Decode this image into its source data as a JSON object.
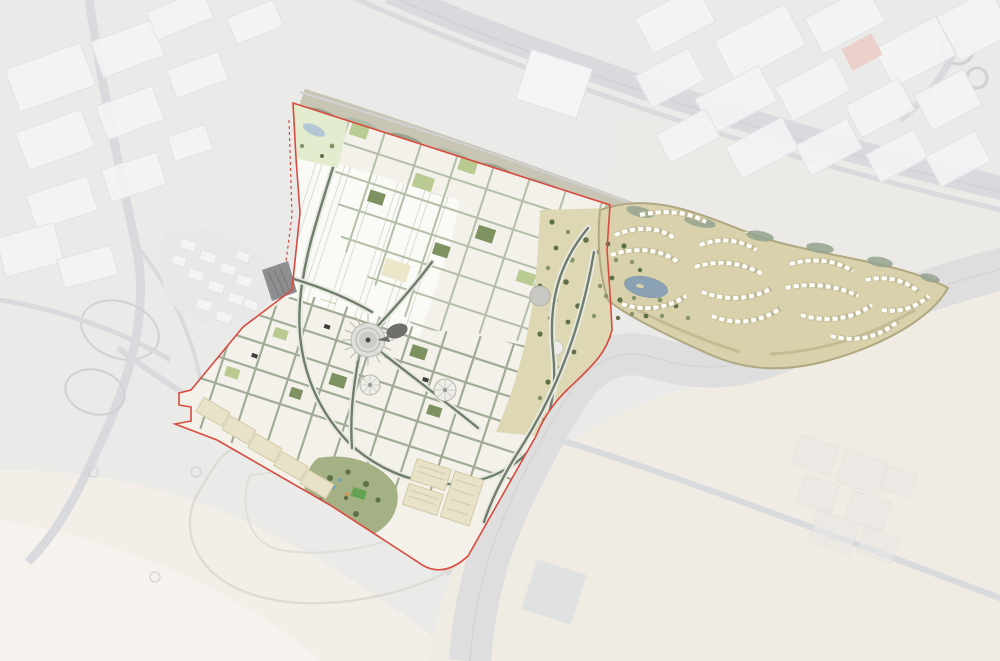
{
  "meta": {
    "type": "masterplan-aerial-map",
    "description": "Aerial-view masterplan rendering: a brightly colored expo-style development site outlined in red over a muted, washed-out desert city context. No visible text labels.",
    "visible_text": []
  },
  "palette": {
    "bg_gray": "#eaeae9",
    "bg_desert": "#f0ebe3",
    "bg_desert_light": "#f3efe8",
    "muted_road": "#d9dadd",
    "muted_road_dark": "#cfd1d5",
    "muted_building": "#f3f4f5",
    "muted_outline": "#e0e2e4",
    "wadi_base": "#c9c5b4",
    "wadi_green": "#94a48e",
    "wadi_green_light": "#adbaa6",
    "site_base": "#f3f1ea",
    "halls_white": "#fafaf7",
    "hall_outline": "#dbdad2",
    "street_sage": "#b3bfa8",
    "street_sage_dark": "#a0ac95",
    "avenue_dark": "#6f7e6c",
    "avenue_casing": "#e9e9e2",
    "block_white": "#f7f6f1",
    "courtyard_green": "#7d9161",
    "courtyard_light": "#b9cb92",
    "tree_dark": "#5f7048",
    "tree_olive": "#87936b",
    "tan_park": "#ded7b3",
    "villa_base": "#d8d1ac",
    "villa_ridge": "#b0a881",
    "villa_row_base": "#c2ba98",
    "villa_white": "#fdfdfa",
    "lake_blue": "#8ba1b4",
    "pond_blue": "#b4c7d5",
    "pond_park": "#e3ecce",
    "plaza_ring": "#dededa",
    "plaza_inner": "#ccccc7",
    "plaza_dark": "#4a4a48",
    "pav_gray": "#c9c8c3",
    "dark_building": "#8e8e90",
    "boundary_red": "#d84b3f",
    "parking_beige": "#e8e2c8",
    "parking_line": "#d3caa6",
    "field_green": "#63a24f",
    "accent_blue": "#6f9ec6",
    "accent_orange": "#d9934e"
  },
  "features": [
    {
      "name": "site-boundary",
      "kind": "red outline around highlighted masterplan site"
    },
    {
      "name": "exhibition-halls",
      "kind": "large white hall buildings, north-west of site"
    },
    {
      "name": "metro-station",
      "kind": "dark grey fan-shaped station on west boundary"
    },
    {
      "name": "pond-park",
      "kind": "small green park with pond, north-west corner"
    },
    {
      "name": "wadi-linear-park",
      "kind": "muted green landscape strip along north edge"
    },
    {
      "name": "north-grid-district",
      "kind": "street grid with green courtyards"
    },
    {
      "name": "central-plaza",
      "kind": "circular plaza with radiating streets"
    },
    {
      "name": "dome-pavilions",
      "kind": "two white circular pavilions south of plaza"
    },
    {
      "name": "grey-dome-pavilion",
      "kind": "grey circular landmark in eastern park"
    },
    {
      "name": "eastern-tan-park",
      "kind": "sandy park with scattered dark trees"
    },
    {
      "name": "south-grid-district",
      "kind": "denser mixed-use street grid"
    },
    {
      "name": "south-park",
      "kind": "green park with bright sports field and play areas"
    },
    {
      "name": "parking-lots",
      "kind": "beige striped parking rows along south-west edge"
    },
    {
      "name": "villa-community",
      "kind": "curving rows of white villas on tan landscape with lake, east of site"
    },
    {
      "name": "villa-lake",
      "kind": "blue lake inside villa community"
    },
    {
      "name": "highway-north",
      "kind": "muted highway across top of image"
    },
    {
      "name": "highway-bend",
      "kind": "wide muted highway curving around south-east of site"
    },
    {
      "name": "industrial-north-west",
      "kind": "muted warehouse district, top-left"
    },
    {
      "name": "industrial-north-east",
      "kind": "muted warehouse district, top-right"
    },
    {
      "name": "desert",
      "kind": "pale sand covering bottom half of image"
    }
  ]
}
